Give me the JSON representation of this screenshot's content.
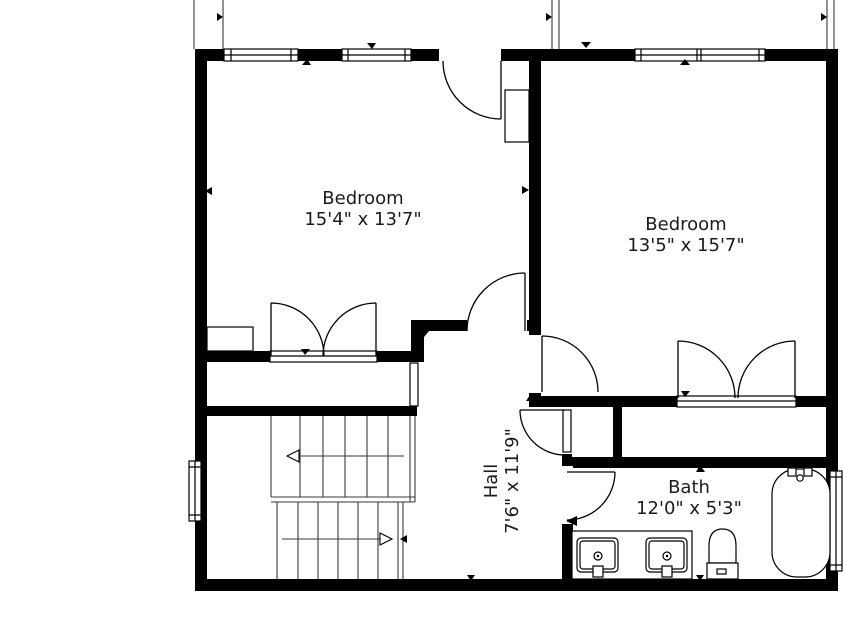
{
  "rooms": {
    "bedroom1": {
      "name": "Bedroom",
      "dims": "15'4\" x 13'7\""
    },
    "bedroom2": {
      "name": "Bedroom",
      "dims": "13'5\" x 15'7\""
    },
    "hall": {
      "name": "Hall",
      "dims": "7'6\" x 11'9\""
    },
    "bath": {
      "name": "Bath",
      "dims": "12'0\" x 5'3\""
    }
  },
  "colors": {
    "wall": "#000000",
    "background": "#ffffff",
    "label_text": "#1b1b1b"
  }
}
